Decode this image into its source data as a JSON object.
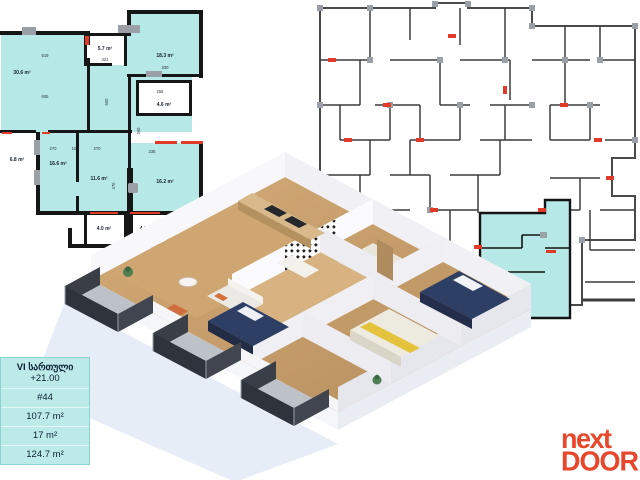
{
  "info_box": {
    "floor_label": "VI სართული",
    "elevation": "+21.00",
    "unit_number": "#44",
    "areas": [
      "107.7 m²",
      "17 m²",
      "124.7 m²"
    ]
  },
  "logo": {
    "line1": "next",
    "line2": "DOOR"
  },
  "unit_plan": {
    "rooms": {
      "living": "30.6 m²",
      "storage": "5.7 m²",
      "bedroom_ne": "18.3 m²",
      "bathroom": "4.6 m²",
      "balcony_w": "6.8 m²",
      "bedroom_w": "16.6 m²",
      "bedroom_c": "11.6 m²",
      "bedroom_e": "16.2 m²",
      "balcony_s1": "4.0 m²",
      "balcony_s2": "4.2 m²"
    },
    "dims": {
      "living_top": "519",
      "living_bottom": "605",
      "hall_v": "500",
      "storage_w": "321",
      "bedroom_ne_w": "330",
      "bath_w": "255",
      "row_left": "270",
      "row_mid": "10",
      "row_right": "270",
      "bedroom_c_v": "470",
      "bedroom_e_top": "235",
      "bedroom_e_v": "340"
    }
  },
  "colors": {
    "highlight_cyan": "#b5e8e7",
    "wall_black": "#161616",
    "marker_red": "#e23a28",
    "window_gray": "#9aa0a6",
    "logo_red": "#e8472c"
  }
}
